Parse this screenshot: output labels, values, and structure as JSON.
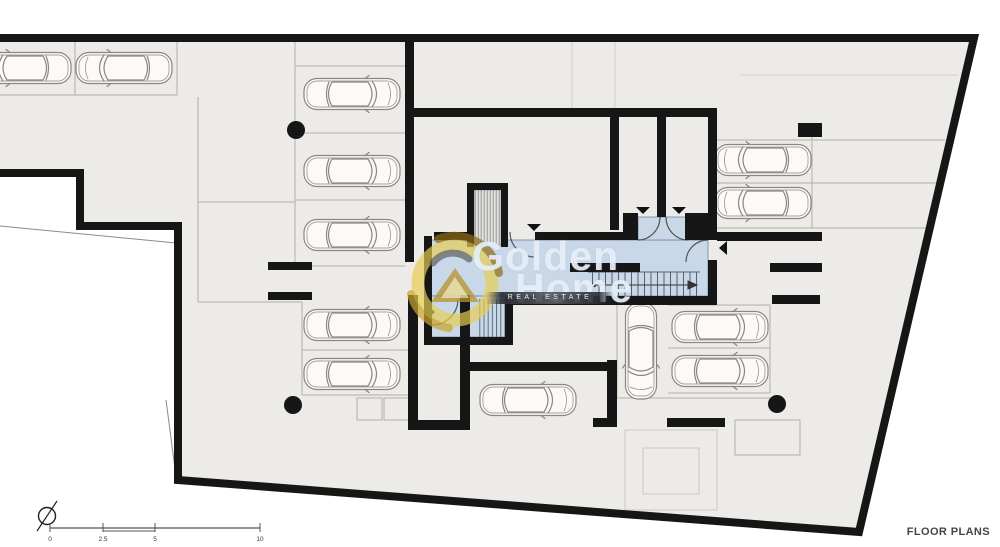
{
  "watermark": {
    "line1": "Golden",
    "line2": "Home",
    "subtitle": "Real Estate"
  },
  "footer": {
    "label": "FLOOR PLANS"
  },
  "scale_bar": {
    "ticks": [
      {
        "label": "0",
        "x": 50
      },
      {
        "label": "2.5",
        "x": 103
      },
      {
        "label": "5",
        "x": 155
      },
      {
        "label": "10",
        "x": 260
      }
    ]
  },
  "colors": {
    "wall": "#161616",
    "floor": "#edebe7",
    "core_fill": "#c8d8e9",
    "core_line": "#72849a",
    "parking_line": "#b3afa9",
    "car_line": "#8a8680",
    "logo_gold": "#e7cd52",
    "logo_gold_dark": "#8f6d14"
  },
  "plan": {
    "cars": [
      {
        "cx": 23,
        "cy": 68,
        "angle": 180
      },
      {
        "cx": 124,
        "cy": 68,
        "angle": 180
      },
      {
        "cx": 352,
        "cy": 94,
        "angle": 0
      },
      {
        "cx": 352,
        "cy": 171,
        "angle": 0
      },
      {
        "cx": 352,
        "cy": 235,
        "angle": 0
      },
      {
        "cx": 352,
        "cy": 325,
        "angle": 0
      },
      {
        "cx": 352,
        "cy": 374,
        "angle": 0
      },
      {
        "cx": 763,
        "cy": 160,
        "angle": 180
      },
      {
        "cx": 763,
        "cy": 203,
        "angle": 180
      },
      {
        "cx": 528,
        "cy": 400,
        "angle": 0
      },
      {
        "cx": 641,
        "cy": 351,
        "angle": 90
      },
      {
        "cx": 720,
        "cy": 327,
        "angle": 0
      },
      {
        "cx": 720,
        "cy": 371,
        "angle": 0
      }
    ],
    "columns": [
      {
        "cx": 296,
        "cy": 130
      },
      {
        "cx": 293,
        "cy": 405
      },
      {
        "cx": 777,
        "cy": 404
      }
    ]
  }
}
